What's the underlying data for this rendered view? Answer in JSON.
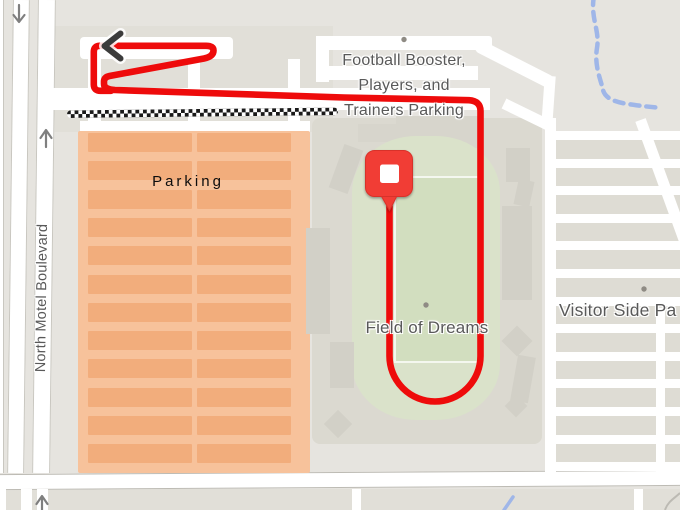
{
  "map": {
    "labels": {
      "football_parking_line1": "Football Booster,",
      "football_parking_line2": "Players, and",
      "football_parking_line3": "Trainers Parking",
      "field_name": "Field of Dreams",
      "visitor_parking": "Visitor Side Pa",
      "parking_area": "Parking",
      "street_name": "North Motel Boulevard"
    },
    "colors": {
      "background": "#E6E4DF",
      "road_white": "#FFFFFF",
      "road_border": "#C9C7C0",
      "block_light": "#E1DFD8",
      "block_gray": "#DEDCD4",
      "stadium_gray": "#DBD9D0",
      "stand_gray": "#D2D0C7",
      "building_gray": "#D7D5CC",
      "field_green": "#DAE2CA",
      "field_inner_green": "#D2DEBF",
      "parking_overlay_orange": "#F7C29B",
      "parking_row_orange": "#F2AD7C",
      "route_red": "#EE0B0B",
      "marker_red": "#F13C34",
      "marker_red_dark": "#D8322B",
      "stream_blue": "#9FB6E8",
      "label_gray": "#595959",
      "arrow_gray": "#7F7F7F",
      "checker_black": "#1A1A1A",
      "poi_dot": "#8F8B84"
    },
    "icons": {
      "destination_marker": "red-square-pin",
      "route_end_arrow": "chevron-left",
      "oneway_south": "down-arrow",
      "oneway_north": "up-arrow"
    }
  }
}
